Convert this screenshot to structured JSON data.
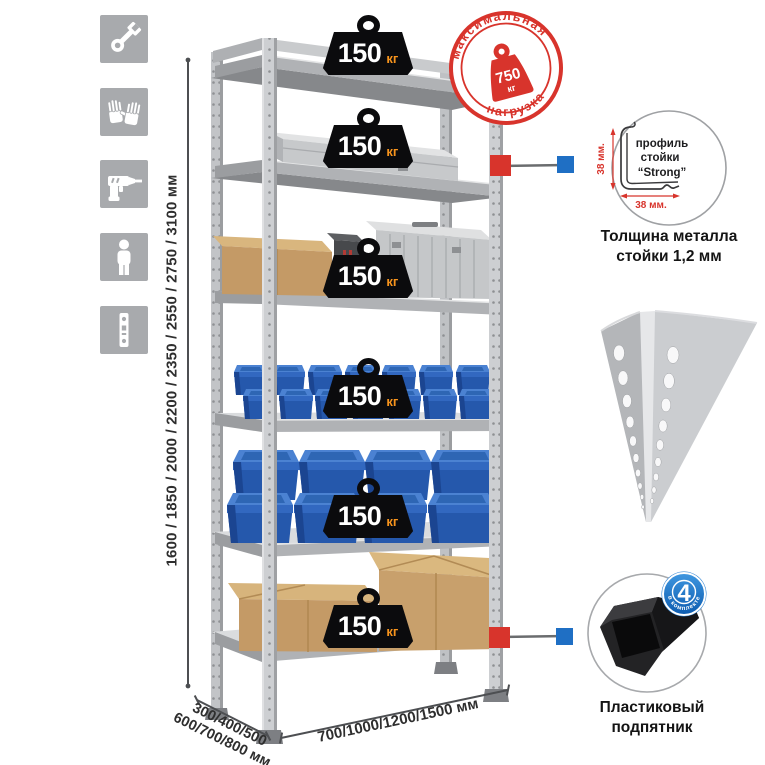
{
  "page": {
    "background": "#ffffff",
    "subject": "Металлический стеллаж — инфографика"
  },
  "sidebar": {
    "icons": [
      {
        "name": "wrench-icon"
      },
      {
        "name": "gloves-icon"
      },
      {
        "name": "drill-icon"
      },
      {
        "name": "person-icon"
      },
      {
        "name": "perforated-strip-icon"
      }
    ]
  },
  "dimensions": {
    "height_label": "1600 / 1850 / 2000 / 2200 / 2350 / 2550 / 2750 / 3100 мм",
    "depth_label_line1": "300/400/500",
    "depth_label_line2": "600/700/800 мм",
    "width_label": "700/1000/1200/1500 мм"
  },
  "badges": {
    "items": [
      {
        "value": "150",
        "unit": "кг"
      },
      {
        "value": "150",
        "unit": "кг"
      },
      {
        "value": "150",
        "unit": "кг"
      },
      {
        "value": "150",
        "unit": "кг"
      },
      {
        "value": "150",
        "unit": "кг"
      },
      {
        "value": "150",
        "unit": "кг"
      }
    ]
  },
  "stamp": {
    "arc_top": "максимальная",
    "arc_bottom": "нагрузка",
    "weight_value": "750",
    "weight_unit": "кг",
    "color": "#d8342c"
  },
  "profile_callout": {
    "vertical_dim": "38 мм.",
    "horizontal_dim": "38 мм.",
    "line1": "профиль",
    "line2": "стойки",
    "line3": "“Strong”",
    "caption1": "Толщина металла",
    "caption2": "стойки 1,2 мм"
  },
  "foot_callout": {
    "count": "4",
    "count_caption": "в комплекте",
    "caption1": "Пластиковый",
    "caption2": "подпятник"
  },
  "colors": {
    "accent_red": "#d8342c",
    "accent_blue": "#1f6fc4",
    "badge_unit_orange": "#f7941d",
    "bin_blue": "#2558ac",
    "metal_gray": "#c2c4c7",
    "cardboard": "#c49a66"
  }
}
